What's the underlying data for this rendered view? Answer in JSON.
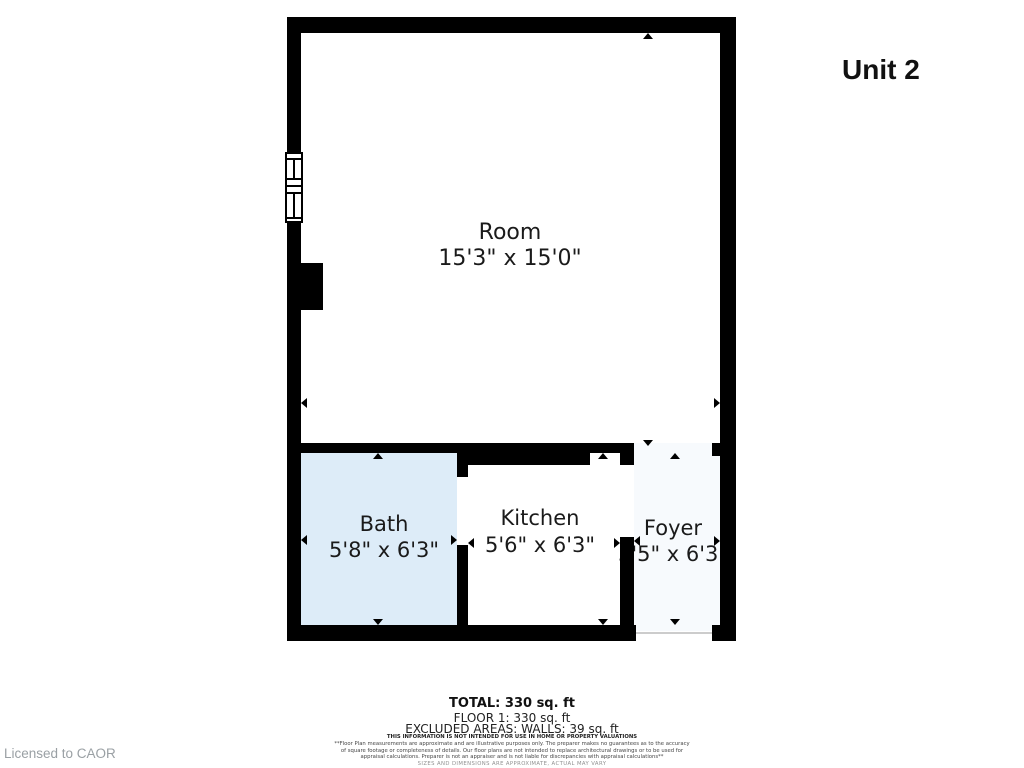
{
  "title": "Unit 2",
  "license": "Licensed to CAOR",
  "rooms": [
    {
      "name": "Room",
      "dims": "15'3\" x 15'0\""
    },
    {
      "name": "Bath",
      "dims": "5'8\" x 6'3\""
    },
    {
      "name": "Kitchen",
      "dims": "5'6\" x 6'3\""
    },
    {
      "name": "Foyer",
      "dims": "3'5\" x 6'3\""
    }
  ],
  "summary": {
    "total": "TOTAL: 330 sq. ft",
    "floor": "FLOOR 1: 330 sq. ft",
    "excluded": "EXCLUDED AREAS: WALLS: 39 sq. ft"
  },
  "disclaimer": {
    "headline": "THIS INFORMATION IS NOT INTENDED FOR USE IN HOME OR PROPERTY VALUATIONS",
    "body1": "**Floor Plan measurements are approximate and are illustrative purposes only. The preparer makes no guarantees as to the accuracy",
    "body2": "of square footage or completeness of details. Our floor plans are not intended to replace architectural drawings or to be used for",
    "body3": "appraisal calculations. Preparer is not an appraiser and is not liable for discrepancies with appraisal calculations**",
    "sizes_note": "SIZES AND DIMENSIONS ARE APPROXIMATE, ACTUAL MAY VARY"
  },
  "colors": {
    "wall": "#000000",
    "bath_fill": "#ddecf8",
    "foyer_fill": "#f7fafd",
    "muted_text": "#9aa0a4"
  }
}
